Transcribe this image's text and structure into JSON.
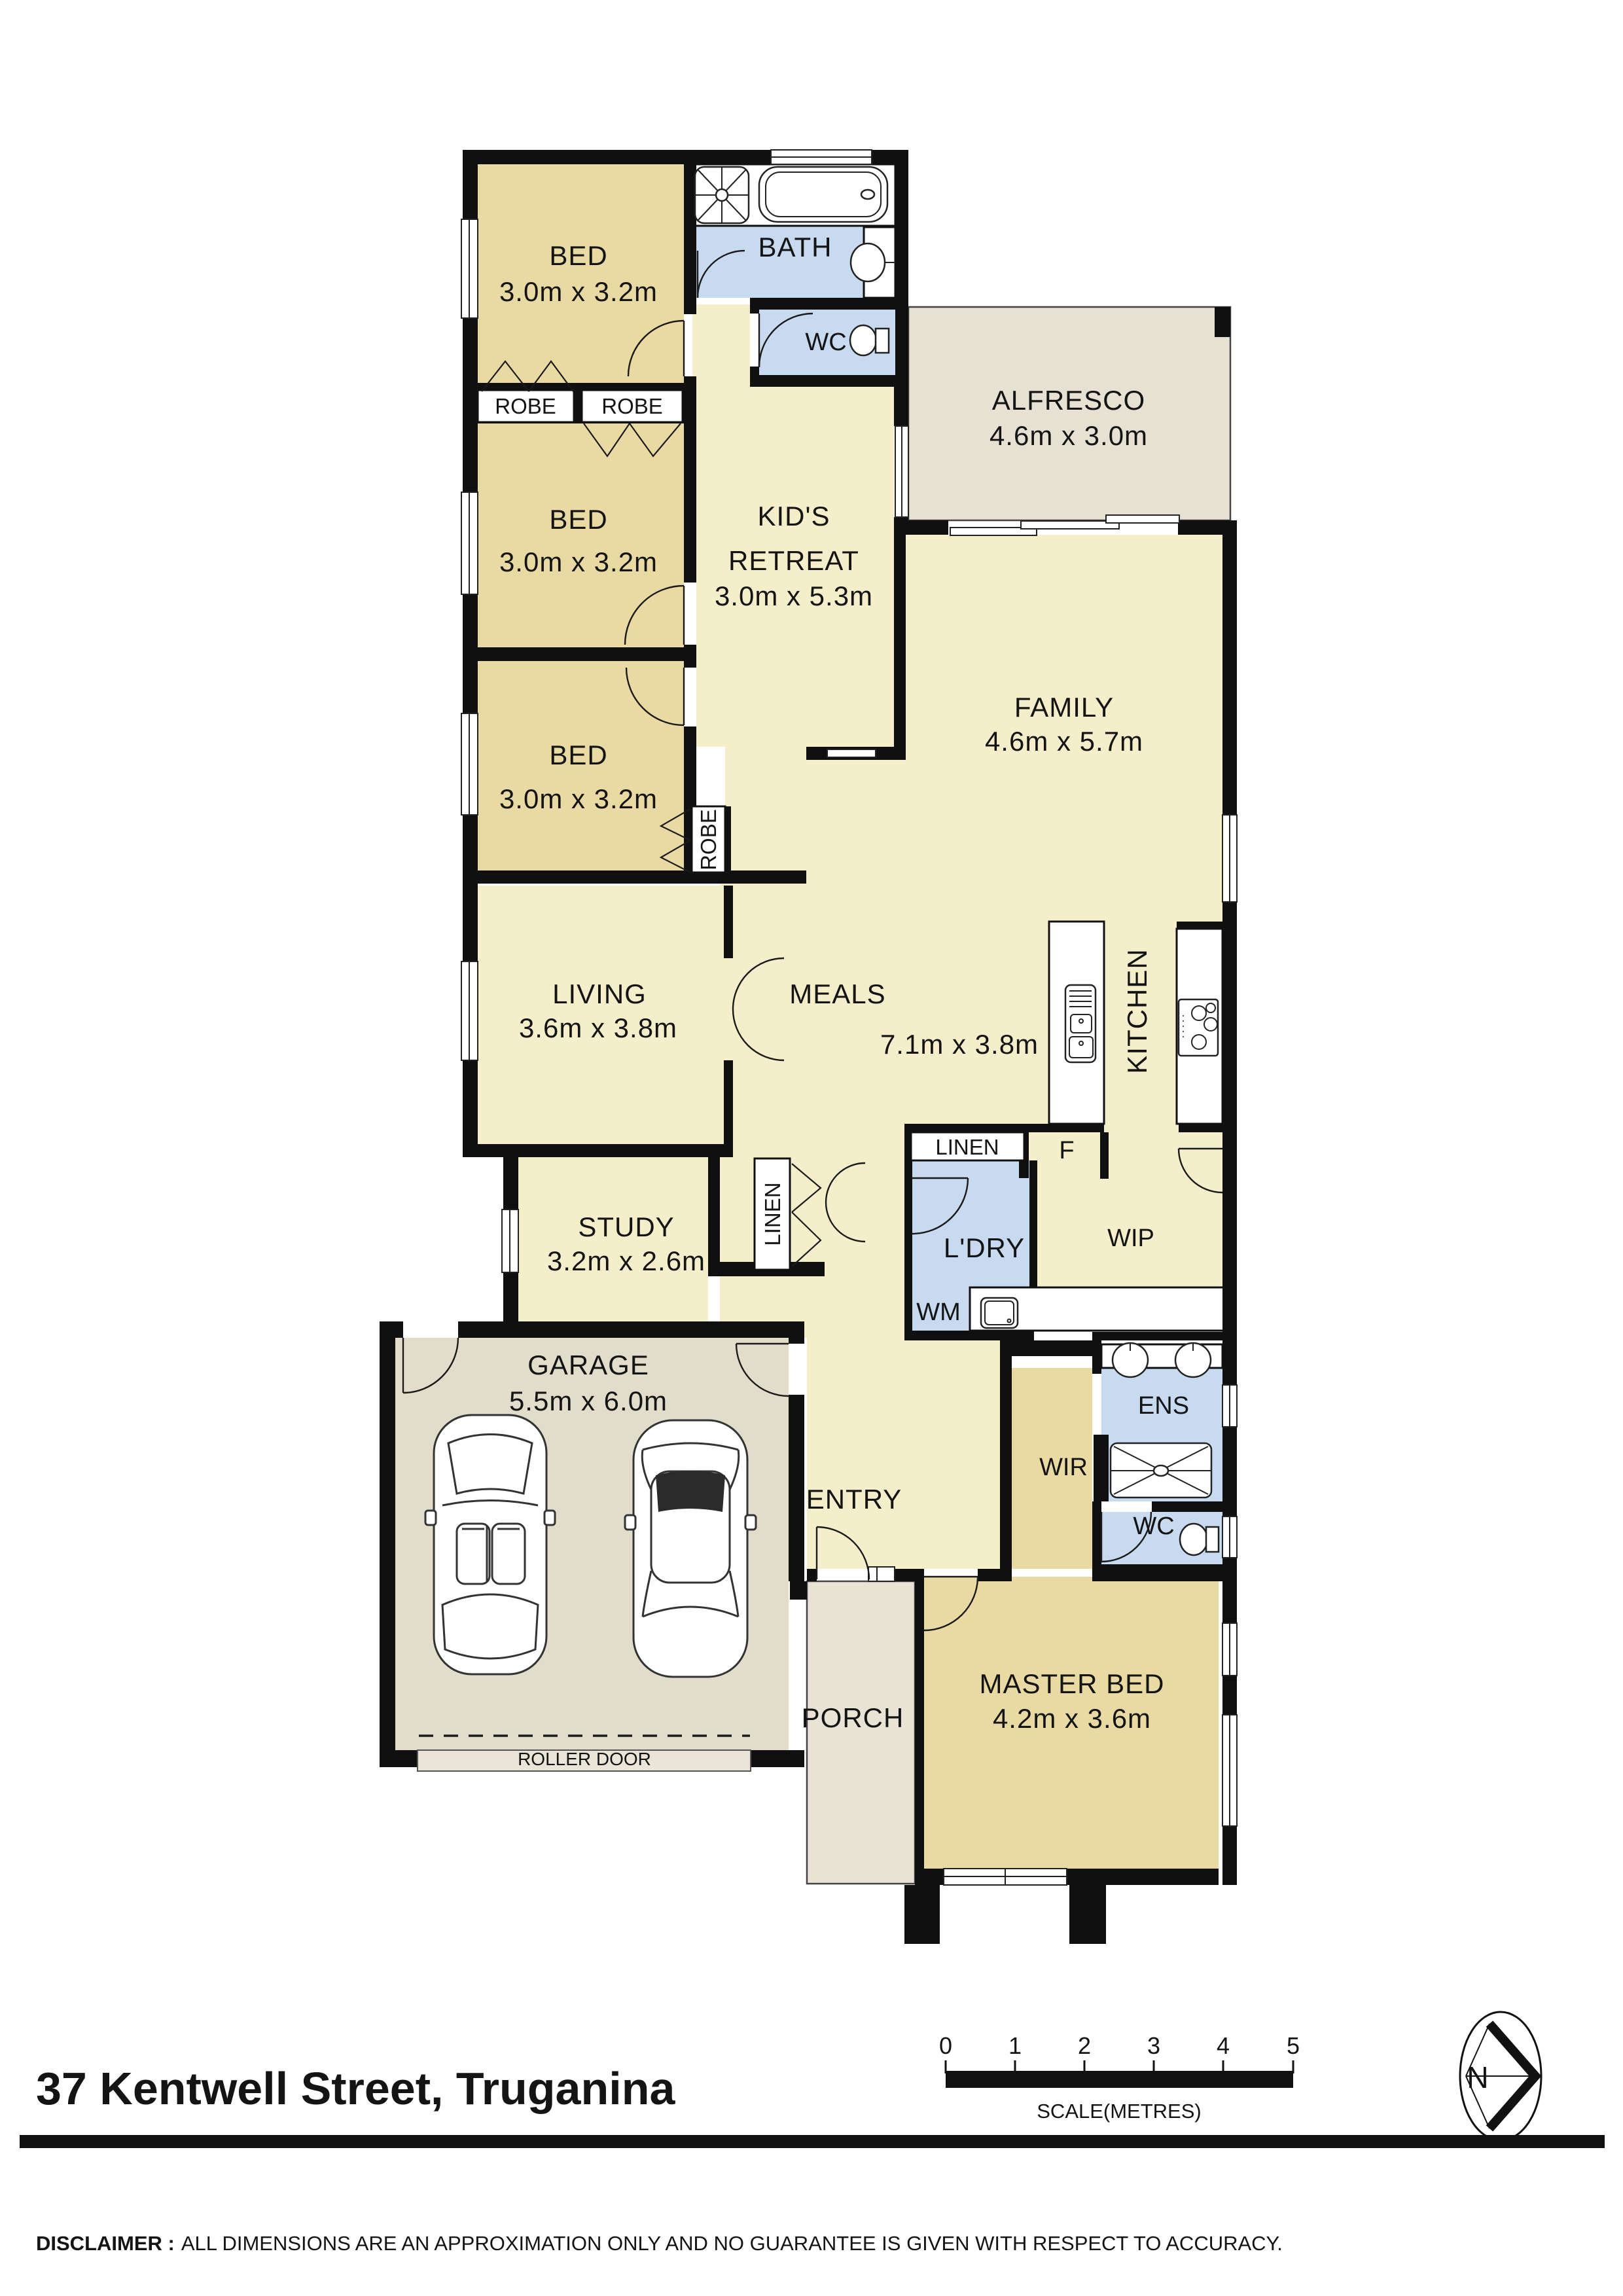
{
  "colors": {
    "wall": "#101010",
    "bedroom": "#e8daa2",
    "living": "#f4efca",
    "wet": "#c7daf0",
    "alfresco": "#e6e1d2",
    "garage": "#e2dccb",
    "porch": "#e9e3d5"
  },
  "rooms": {
    "bed1": {
      "label": "BED",
      "dims": "3.0m x 3.2m"
    },
    "bed2": {
      "label": "BED",
      "dims": "3.0m x 3.2m"
    },
    "bed3": {
      "label": "BED",
      "dims": "3.0m x 3.2m"
    },
    "bath": {
      "label": "BATH"
    },
    "wc_main": {
      "label": "WC"
    },
    "alfresco": {
      "label": "ALFRESCO",
      "dims": "4.6m x 3.0m"
    },
    "kids_retreat": {
      "label_line1": "KID'S",
      "label_line2": "RETREAT",
      "dims": "3.0m x 5.3m"
    },
    "family": {
      "label": "FAMILY",
      "dims": "4.6m x 5.7m"
    },
    "living": {
      "label": "LIVING",
      "dims": "3.6m x 3.8m"
    },
    "meals": {
      "label": "MEALS",
      "dims": "7.1m x 3.8m"
    },
    "kitchen": {
      "label": "KITCHEN"
    },
    "robe1": {
      "label": "ROBE"
    },
    "robe2": {
      "label": "ROBE"
    },
    "robe3": {
      "label": "ROBE"
    },
    "linen_kitchen": {
      "label": "LINEN"
    },
    "fridge": {
      "label": "F"
    },
    "laundry": {
      "label": "L'DRY",
      "wm": "WM"
    },
    "wip": {
      "label": "WIP"
    },
    "study": {
      "label": "STUDY",
      "dims": "3.2m x 2.6m"
    },
    "linen_hall": {
      "label": "LINEN"
    },
    "garage": {
      "label": "GARAGE",
      "dims": "5.5m x 6.0m",
      "roller": "ROLLER DOOR"
    },
    "entry": {
      "label": "ENTRY"
    },
    "porch": {
      "label": "PORCH"
    },
    "wir": {
      "label": "WIR"
    },
    "ens": {
      "label": "ENS"
    },
    "wc_ens": {
      "label": "WC"
    },
    "master": {
      "label": "MASTER BED",
      "dims": "4.2m x 3.6m"
    }
  },
  "footer": {
    "title": "37 Kentwell Street, Truganina",
    "scale_ticks": [
      "0",
      "1",
      "2",
      "3",
      "4",
      "5"
    ],
    "scale_caption": "SCALE(METRES)",
    "north_label": "N",
    "disclaimer_bold": "DISCLAIMER :",
    "disclaimer_text": "ALL DIMENSIONS ARE AN APPROXIMATION ONLY AND NO GUARANTEE IS GIVEN WITH RESPECT TO ACCURACY."
  }
}
